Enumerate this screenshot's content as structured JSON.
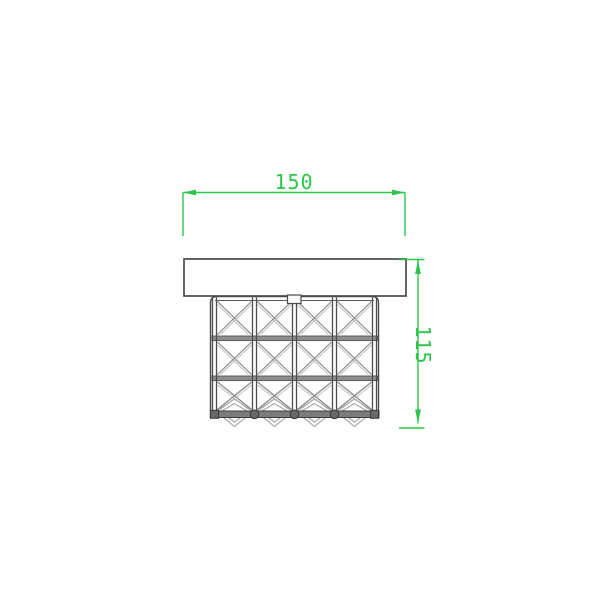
{
  "page": {
    "background": "#ffffff",
    "kind": "technical-dimension-drawing"
  },
  "drawing": {
    "width_dimension": {
      "value": "150",
      "orientation": "horizontal"
    },
    "height_dimension": {
      "value": "115",
      "orientation": "vertical"
    },
    "fixture": {
      "grid_columns": 4,
      "grid_rows": 3,
      "cell_pattern": "x-cross-lattice",
      "pendant_count": 4
    },
    "colors": {
      "dimension_green": "#2cc64a",
      "outline": "#4a4a4a",
      "rail_gray": "#8e8e8e",
      "lattice_gray": "#878787",
      "lattice_light": "#bdbdbd",
      "pendant_gray": "#a3a3a3"
    }
  }
}
